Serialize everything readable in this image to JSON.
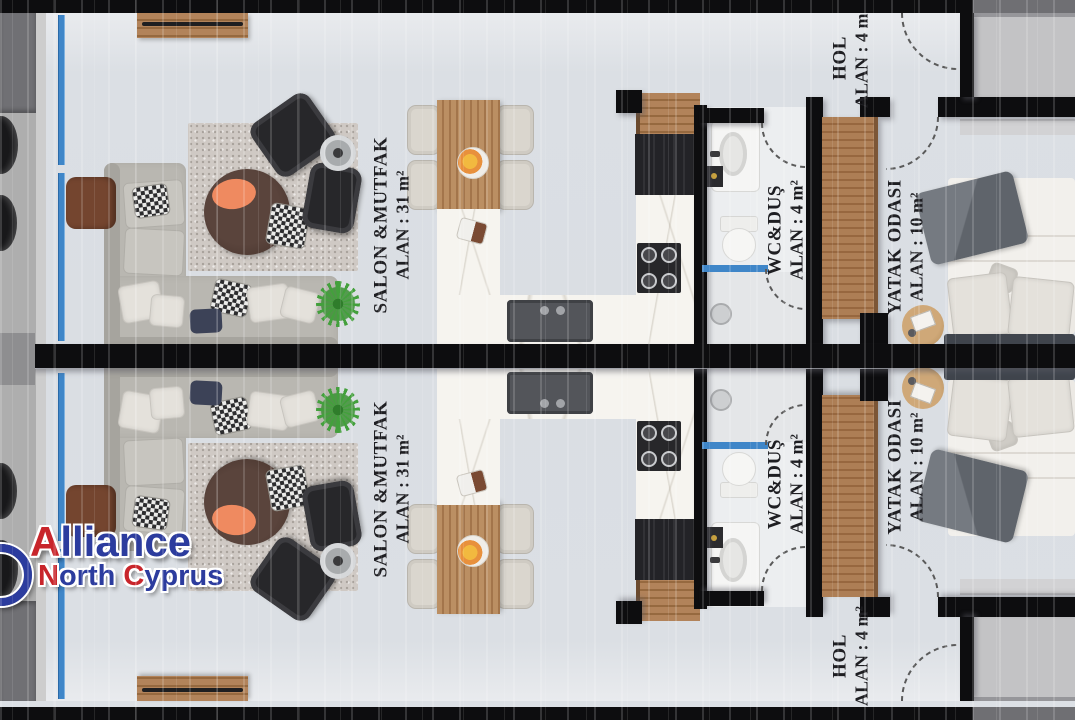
{
  "rooms": {
    "living": {
      "label": "SALON &MUTFAK",
      "area": "ALAN : 31 m²"
    },
    "bathroom": {
      "label": "WC&DUŞ",
      "area": "ALAN : 4 m²"
    },
    "bedroom": {
      "label": "YATAK ODASI",
      "area": "ALAN : 10 m²"
    },
    "hall": {
      "label": "HOL",
      "area": "ALAN : 4 m²"
    }
  },
  "watermark": {
    "line1_accent": "A",
    "line1_rest": "lliance",
    "line2_word1_accent": "N",
    "line2_word1_rest": "orth ",
    "line2_word2_accent": "C",
    "line2_word2_rest": "yprus"
  },
  "colors": {
    "wall": "#0d0d0f",
    "floor": "#dce0e5",
    "window_glass": "#3f86c8",
    "wood": "#a3754b",
    "logo_blue": "#2c3c9e",
    "logo_red": "#c8252b"
  }
}
